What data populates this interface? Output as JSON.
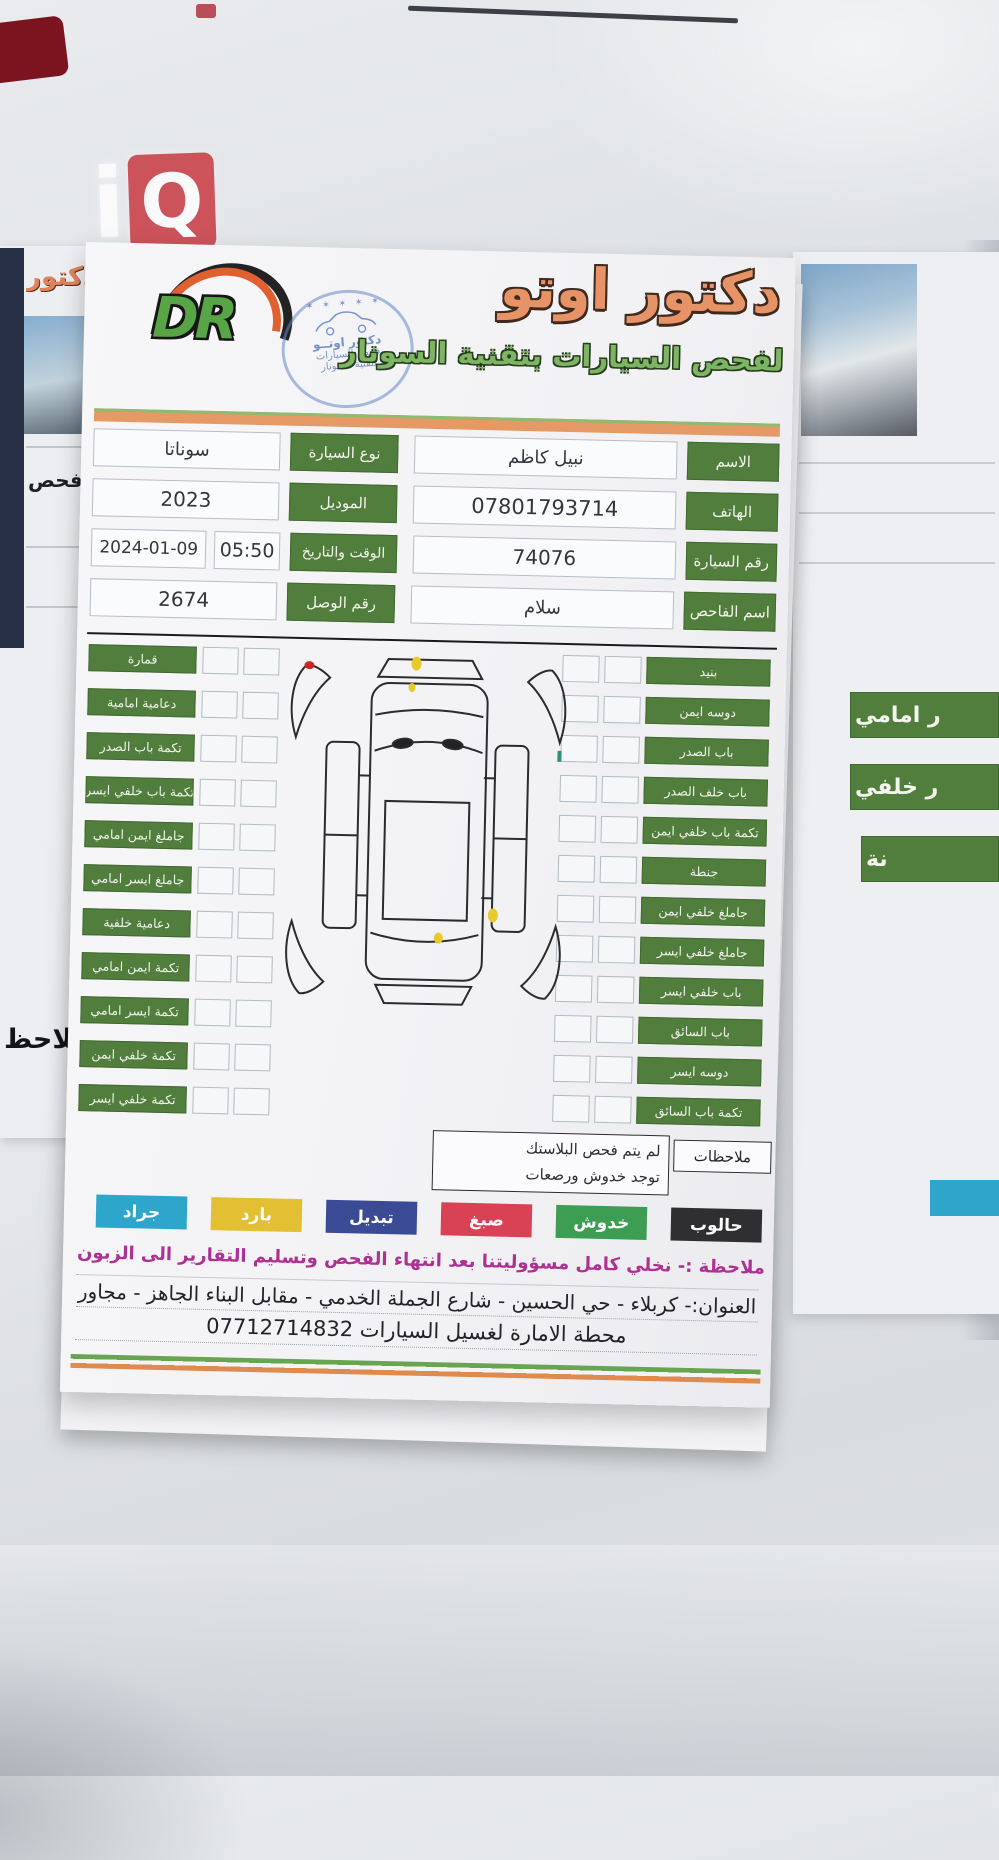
{
  "watermark": {
    "text_i": "i",
    "text_q": "Q"
  },
  "left_paper": {
    "title_fragment": "دكتور",
    "mid_fragment": "فحص",
    "bottom_fragment": "ملاحظ"
  },
  "right_paper": {
    "labels": [
      "ر امامي",
      "ر خلفي",
      "نة"
    ]
  },
  "header": {
    "logo_text": "DR",
    "title": "دكتور اوتو",
    "subtitle": "لفحص السيارات بتقنية السونار",
    "stamp": {
      "stars": "✶ ✶ ✶ ✶ ✶",
      "line1": "دكتور اوتــو",
      "line2": "فحص السيارات",
      "line3": "بتقنية السونار"
    }
  },
  "info": {
    "right_rows": [
      {
        "label": "الاسم",
        "value": "نبيل كاظم"
      },
      {
        "label": "الهاتف",
        "value": "07801793714"
      },
      {
        "label": "رقم السيارة",
        "value": "74076"
      },
      {
        "label": "اسم الفاحص",
        "value": "سلام"
      }
    ],
    "left_rows": [
      {
        "label": "نوع السيارة",
        "value": "سوناتا"
      },
      {
        "label": "الموديل",
        "value": "2023"
      },
      {
        "label": "الوقت والتاريخ",
        "value": "2024-01-09",
        "value2": "05:50"
      },
      {
        "label": "رقم الوصل",
        "value": "2674"
      }
    ]
  },
  "checklist": {
    "left_items": [
      "قمارة",
      "دعامية امامية",
      "تكمة باب الصدر",
      "تكمة باب خلفي ايسر",
      "جاملغ ايمن امامي",
      "جاملغ ايسر امامي",
      "دعامية خلفية",
      "تكمة ايمن امامي",
      "تكمة ايسر امامي",
      "تكمة خلفي ايمن",
      "تكمة خلفي ايسر"
    ],
    "right_items": [
      "بنيد",
      "دوسه ايمن",
      "باب الصدر",
      "باب خلف الصدر",
      "تكمة باب خلفي ايمن",
      "جنطة",
      "جاملغ خلفي ايمن",
      "جاملغ خلفي ايسر",
      "باب خلفي ايسر",
      "باب السائق",
      "دوسه ايسر",
      "تكمة باب السائق"
    ]
  },
  "notes": {
    "label": "ملاحظات",
    "line1": "لم يتم فحص البلاستك",
    "line2": "توجد خدوش ورصعات"
  },
  "legend": [
    {
      "label": "حالوب",
      "color": "#2f2f31"
    },
    {
      "label": "خدوش",
      "color": "#3d9e53"
    },
    {
      "label": "صبغ",
      "color": "#d84254"
    },
    {
      "label": "تبديل",
      "color": "#3b4a94"
    },
    {
      "label": "بارد",
      "color": "#e3bf33"
    },
    {
      "label": "جراد",
      "color": "#2ea6cb"
    }
  ],
  "disclaimer": "ملاحظة :- نخلي كامل مسؤوليتنا بعد انتهاء الفحص وتسليم التقارير الى الزبون",
  "address": {
    "line1": "العنوان:- كربلاء - حي الحسين - شارع الجملة الخدمي - مقابل البناء الجاهز - مجاور",
    "line2": "محطة الامارة لغسيل السيارات 07712714832"
  },
  "colors": {
    "label_green": "#527e3d",
    "title_orange": "#e79368",
    "subtitle_green": "#7eb565",
    "disclaimer_magenta": "#ae3093",
    "stamp_blue": "#5578be"
  }
}
